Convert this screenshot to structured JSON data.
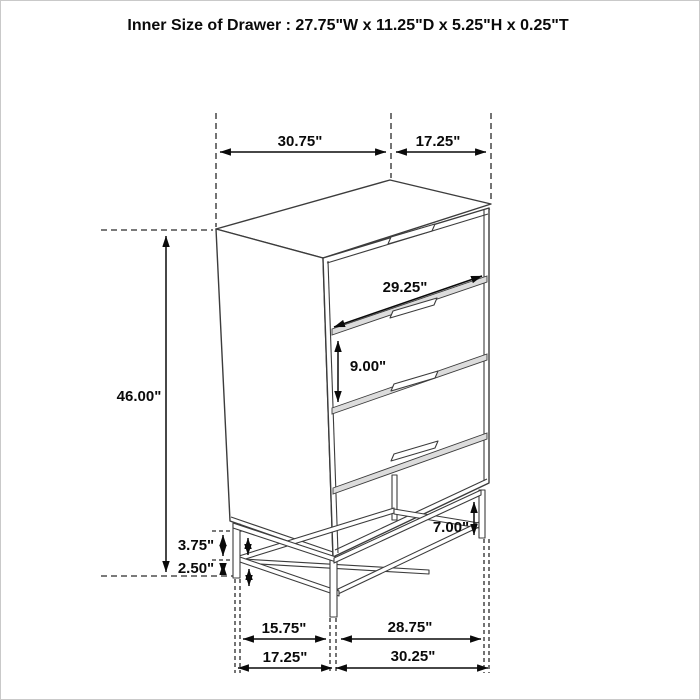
{
  "title": "Inner Size of Drawer : 27.75\"W x 11.25\"D x 5.25\"H x 0.25\"T",
  "dimensions": {
    "top_width": "30.75\"",
    "top_depth": "17.25\"",
    "overall_height": "46.00\"",
    "drawer_front_width": "29.25\"",
    "drawer_front_height": "9.00\"",
    "base_leg_height": "7.00\"",
    "base_rail_gap": "3.75\"",
    "base_floor_gap": "2.50\"",
    "base_inner_depth": "15.75\"",
    "base_inner_width": "28.75\"",
    "base_outer_depth": "17.25\"",
    "base_outer_width": "30.25\""
  },
  "colors": {
    "line": "#3c3c3c",
    "dimension": "#0a0a0a",
    "separator_fill": "#dcdcdc",
    "background": "#ffffff",
    "border": "#c9c9c9"
  }
}
